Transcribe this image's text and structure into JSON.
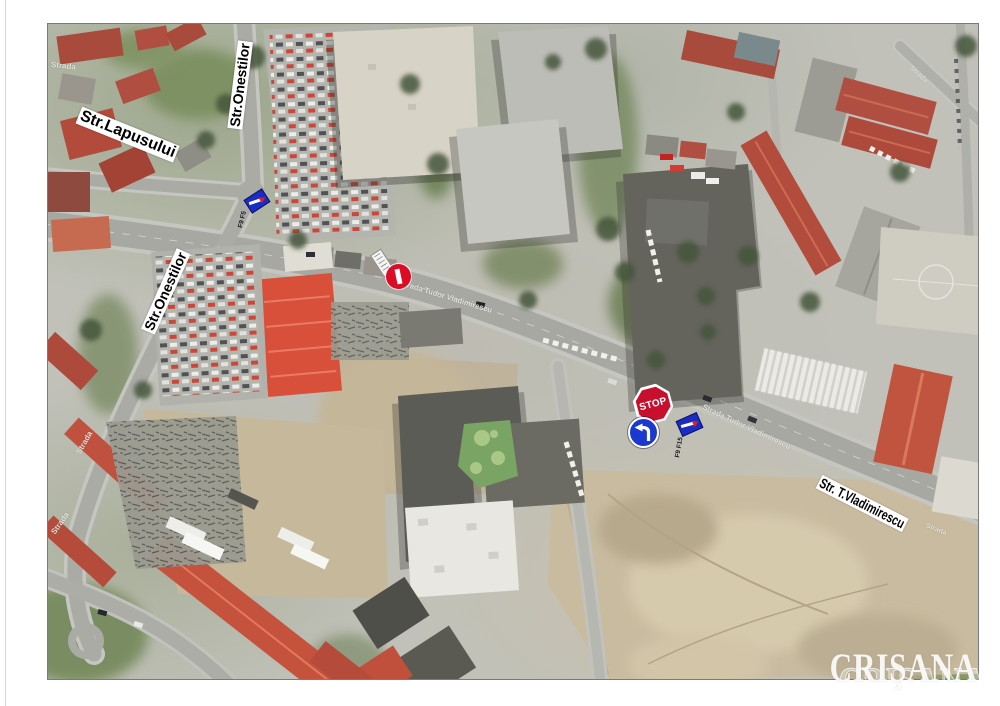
{
  "street_labels": {
    "lapusului": {
      "text": "Str.Lapusului"
    },
    "onestilor_top": {
      "text": "Str.Onestilor"
    },
    "onestilor_mid": {
      "text": "Str.Onestilor"
    },
    "vladimirescu": {
      "text": "Str. T.Vladimirescu"
    }
  },
  "road_captions": {
    "main_road_west": "Strada Tudor Vladimirescu",
    "main_road_east": "Strada Tudor Vladimirescu",
    "main_road_far_east": "Strada",
    "left_road_upper": "Strada",
    "left_road_lower": "Strada",
    "top_left": "Strada",
    "top_right": "Strada"
  },
  "traffic_signs": {
    "stop": {
      "label": "STOP",
      "color": "#c8102e"
    },
    "no_entry": {
      "color": "#dd0c26"
    },
    "turn_left": {
      "color": "#1c39cf"
    },
    "marker_north": {
      "code": "F9 F5",
      "color": "#1b2cc4"
    },
    "marker_east": {
      "code": "F9 F15",
      "color": "#1b2cc4"
    }
  },
  "watermark": {
    "text": "CRIŞANA"
  }
}
